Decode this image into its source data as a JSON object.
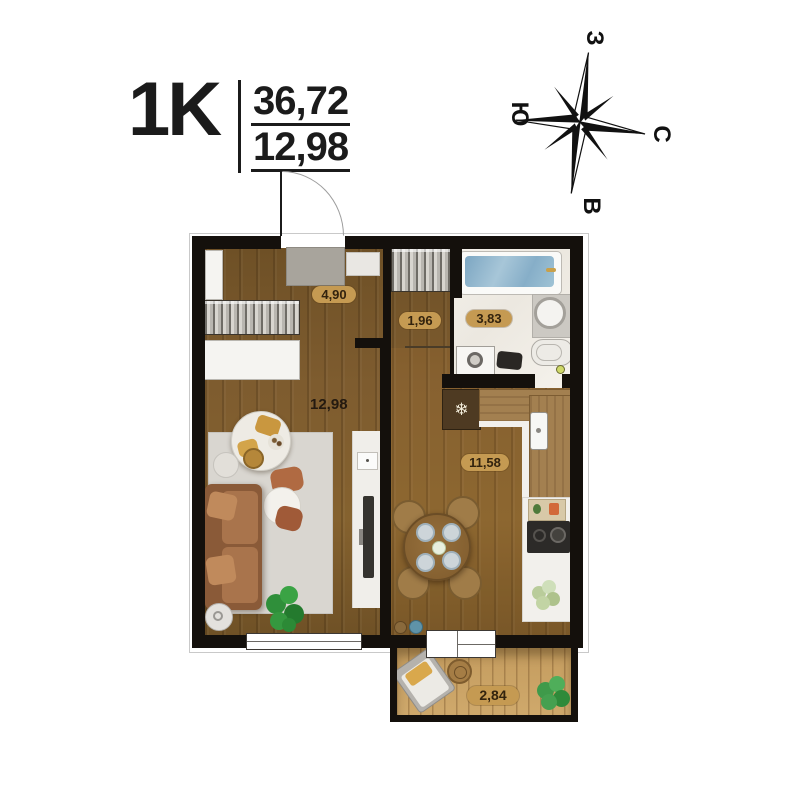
{
  "header": {
    "plan_type": "1K",
    "total_area": "36,72",
    "living_area": "12,98"
  },
  "compass": {
    "top": "З",
    "left": "Ю",
    "right": "С",
    "bottom": "В"
  },
  "rooms": {
    "hallway": {
      "area": "4,90"
    },
    "closet": {
      "area": "1,96"
    },
    "bathroom": {
      "area": "3,83"
    },
    "living": {
      "area": "12,98"
    },
    "kitchen": {
      "area": "11,58"
    },
    "balcony": {
      "area": "2,84"
    }
  },
  "icons": {
    "fridge_snowflake": "❄"
  },
  "colors": {
    "wall": "#14100c",
    "wood_floor": "#7e5c2f",
    "balcony_floor": "#c9a263",
    "bathroom_tile": "#f0ede7",
    "label_pill": "#c59a52",
    "label_text": "#33230e",
    "bath_water": "#8fb6cf",
    "sofa_leather": "#a06a48"
  }
}
